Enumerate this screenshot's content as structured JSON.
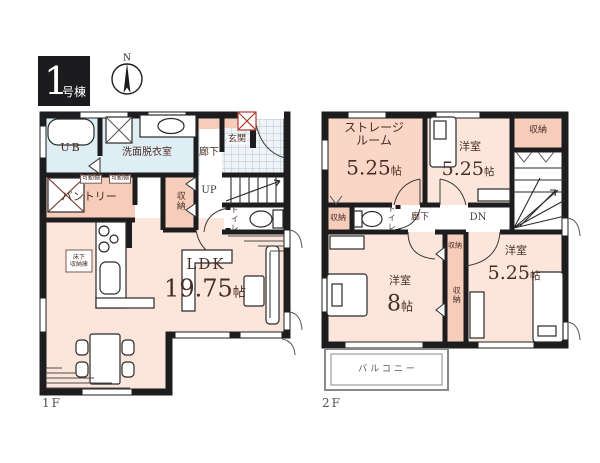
{
  "badge": {
    "number": "1",
    "suffix": "号棟"
  },
  "compass": {
    "label": "N"
  },
  "floor1": {
    "label": "1F",
    "ub": "UB",
    "washroom": "洗面脱衣室",
    "hallway": "廊下",
    "entrance": "玄関",
    "up": "UP",
    "closet": "収納",
    "toilet": "トイレ",
    "pantry": "パントリー",
    "shelf_left": "可動棚",
    "shelf_right": "可動棚",
    "underfloor_line1": "床下",
    "underfloor_line2": "収納庫",
    "ldk": "LDK",
    "ldk_size_num": "19.75",
    "ldk_size_unit": "帖"
  },
  "floor2": {
    "label": "2F",
    "storage_room_line1": "ストレージ",
    "storage_room_line2": "ルーム",
    "storage_size_num": "5.25",
    "storage_size_unit": "帖",
    "bedroom_top": "洋室",
    "bedroom_top_num": "5.25",
    "bedroom_top_unit": "帖",
    "closet_top": "収納",
    "hallway": "廊下",
    "dn": "DN",
    "toilet": "トイレ",
    "closet_left": "収納",
    "closet_mid": "収納",
    "closet_vertical": "収納",
    "bedroom_left": "洋室",
    "bedroom_left_num": "8",
    "bedroom_left_unit": "帖",
    "bedroom_right": "洋室",
    "bedroom_right_num": "5.25",
    "bedroom_right_unit": "帖",
    "balcony": "バルコニー"
  },
  "colors": {
    "wall": "#1d1d1f",
    "room_pink": "#fce6db",
    "room_pink_dark": "#f6cdbb",
    "storage_pink": "#f9d6c6",
    "wet_blue": "#dfeef4",
    "label_maroon": "#4a2c26",
    "muted_gray": "#56504e",
    "accent_red": "#b03a2e",
    "tile_line": "#b8c6ce"
  }
}
